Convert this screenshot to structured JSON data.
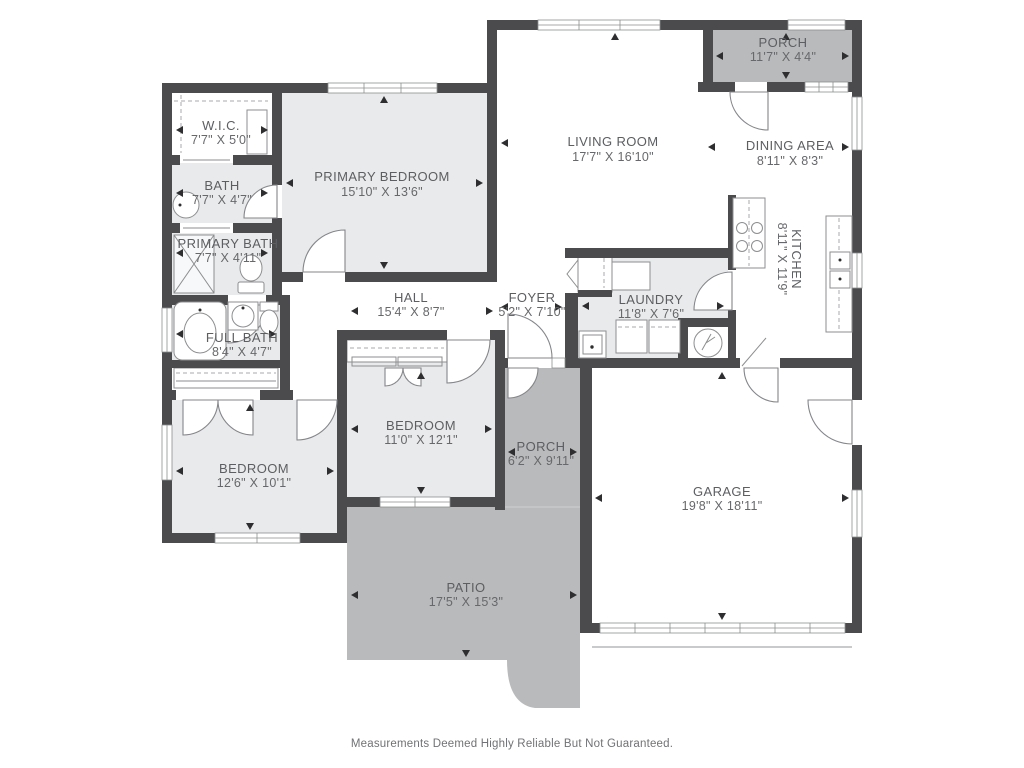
{
  "colors": {
    "wall": "#4b4b4d",
    "interior_room_fill": "#e9eaeb",
    "outdoor_fill": "#b9babc",
    "label_text": "#5c5e61"
  },
  "rooms": {
    "rear_porch": {
      "name": "PORCH",
      "dims": "11'7\" X 4'4\""
    },
    "living_room": {
      "name": "LIVING ROOM",
      "dims": "17'7\" X 16'10\""
    },
    "dining_area": {
      "name": "DINING AREA",
      "dims": "8'11\" X 8'3\""
    },
    "kitchen": {
      "name": "KITCHEN",
      "dims": "8'11\" X 11'9\""
    },
    "wic": {
      "name": "W.I.C.",
      "dims": "7'7\" X 5'0\""
    },
    "bath": {
      "name": "BATH",
      "dims": "7'7\" X 4'7\""
    },
    "primary_bath": {
      "name": "PRIMARY BATH",
      "dims": "7'7\" X 4'11\""
    },
    "primary_bedroom": {
      "name": "PRIMARY BEDROOM",
      "dims": "15'10\" X 13'6\""
    },
    "hall": {
      "name": "HALL",
      "dims": "15'4\" X 8'7\""
    },
    "foyer": {
      "name": "FOYER",
      "dims": "5'2\" X 7'10\""
    },
    "laundry": {
      "name": "LAUNDRY",
      "dims": "11'8\" X 7'6\""
    },
    "full_bath": {
      "name": "FULL BATH",
      "dims": "8'4\" X 4'7\""
    },
    "bedroom_center": {
      "name": "BEDROOM",
      "dims": "11'0\" X 12'1\""
    },
    "bedroom_left": {
      "name": "BEDROOM",
      "dims": "12'6\" X 10'1\""
    },
    "front_porch": {
      "name": "PORCH",
      "dims": "6'2\" X 9'11\""
    },
    "garage": {
      "name": "GARAGE",
      "dims": "19'8\" X 18'11\""
    },
    "patio": {
      "name": "PATIO",
      "dims": "17'5\" X 15'3\""
    }
  },
  "footer": {
    "disclaimer": "Measurements Deemed Highly Reliable But Not Guaranteed."
  }
}
